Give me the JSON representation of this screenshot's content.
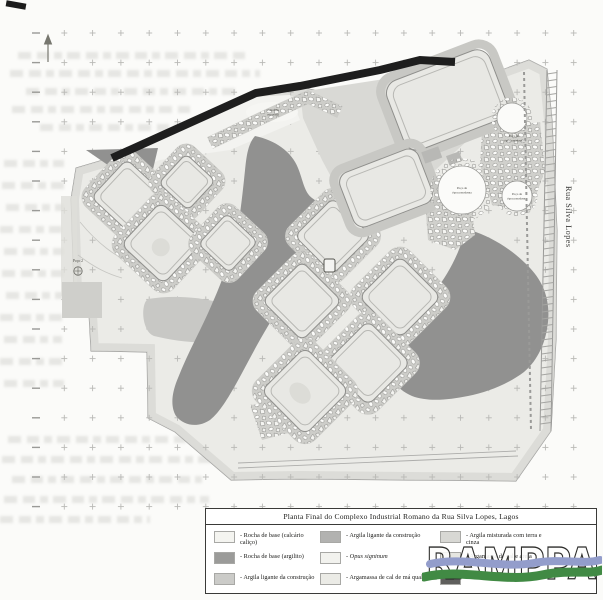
{
  "page": {
    "paper_color": "#fbfbf9"
  },
  "map": {
    "street_label": "Rua Silva Lopes",
    "labels": {
      "unexcavated": [
        "Zona não",
        "escavada"
      ],
      "well_modern": [
        "Poço de",
        "época moderna"
      ],
      "well_left": "Poço 2"
    },
    "icons": [
      "north-arrow-icon",
      "well-icon"
    ],
    "colors": {
      "plan_fill": "#ebebe7",
      "argilito_dark": "#919190",
      "wall_black": "#1e1e1e",
      "tank_fill": "#e8e8e4"
    }
  },
  "legend": {
    "title": "Planta Final do Complexo Industrial Romano da Rua Silva Lopes, Lagos",
    "items": [
      {
        "label": "- Rocha de base (calcário caliço)",
        "color": "#f4f4f0"
      },
      {
        "label": "- Rocha de base (argilito)",
        "color": "#9b9b99"
      },
      {
        "label": "- Argila ligante da construção",
        "color": "#cbcbc8"
      },
      {
        "label": "- Argila ligante da construção",
        "color": "#b2b2b0"
      },
      {
        "label": "- Opus signinum",
        "color": "#f2f2ee"
      },
      {
        "label": "- Argamassa de cal de má qualidade",
        "color": "#ebebe6"
      },
      {
        "label": "- Argila misturada com terra e cinza",
        "color": "#d8d8d4"
      },
      {
        "label": "- Argamassa de cal e areia",
        "color": "#e6e6e1"
      },
      {
        "label": "- Destruições recentes",
        "color": "#5f5f5d"
      }
    ]
  },
  "logo": {
    "text": "RAMPPA",
    "wave_blue": "#939DCB",
    "wave_green": "#418A44"
  }
}
